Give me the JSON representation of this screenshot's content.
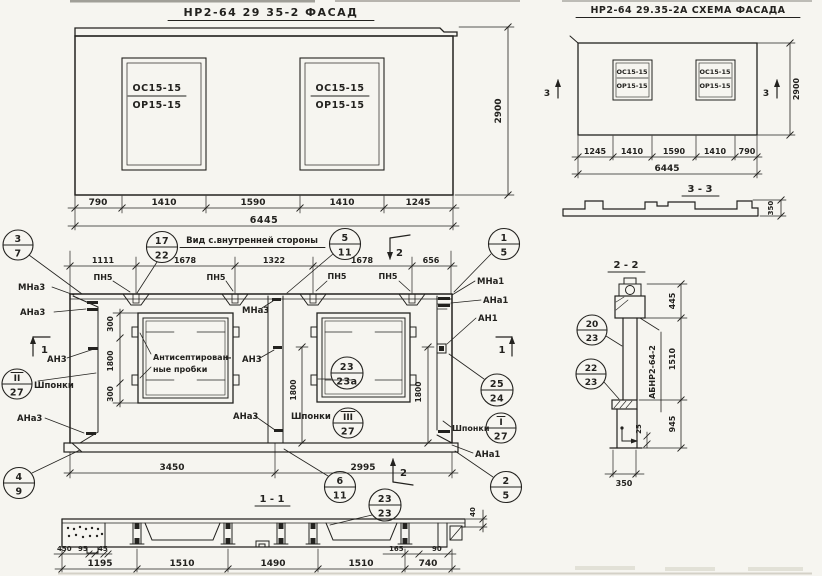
{
  "palette": {
    "ink": "#23221f",
    "paper": "#f6f5f0"
  },
  "facade": {
    "title": "НР2-64 29 35-2 ФАСАД",
    "win_top": "ОС15-15",
    "win_bot": "ОР15-15",
    "height": "2900",
    "dims": [
      "790",
      "1410",
      "1590",
      "1410",
      "1245"
    ],
    "total": "6445"
  },
  "schema": {
    "title": "НР2-64 29.35-2А СХЕМА ФАСАДА",
    "win_top": "ОС15-15",
    "win_bot": "ОР15-15",
    "height": "2900",
    "dims": [
      "1245",
      "1410",
      "1590",
      "1410",
      "790"
    ],
    "total": "6445",
    "cut": "3"
  },
  "sec33": {
    "title": "3 - 3",
    "dim350": "350"
  },
  "view": {
    "title": "Вид с.внутренней стороны",
    "top_dims": [
      "1111",
      "1678",
      "1322",
      "1678",
      "656"
    ],
    "pn5": "ПН5",
    "mna3": "МНа3",
    "ana3": "АНа3",
    "an3": "АН3",
    "mna1": "МНа1",
    "ana1": "АНа1",
    "an1": "АН1",
    "shponki": "Шпонки",
    "note1": "Антисептирован-",
    "note2": "ные пробки",
    "d300": "300",
    "d1800": "1800",
    "d3450": "3450",
    "d2995": "2995",
    "cut1": "1",
    "cut2": "2",
    "c37": [
      "3",
      "7"
    ],
    "c1722": [
      "17",
      "22"
    ],
    "c511": [
      "5",
      "11"
    ],
    "c15": [
      "1",
      "5"
    ],
    "c2323a": [
      "23",
      "23а"
    ],
    "c2524": [
      "25",
      "24"
    ],
    "cI27": [
      "I",
      "27"
    ],
    "cII27": [
      "II",
      "27"
    ],
    "cIII27": [
      "III",
      "27"
    ],
    "c49": [
      "4",
      "9"
    ],
    "c611": [
      "6",
      "11"
    ],
    "c2323": [
      "23",
      "23"
    ],
    "c25": [
      "2",
      "5"
    ]
  },
  "sec11": {
    "title": "1 - 1",
    "small_left": [
      "450",
      "95",
      "45"
    ],
    "dims": [
      "1195",
      "1510",
      "1490",
      "1510",
      "740"
    ],
    "small_right": [
      "165",
      "90"
    ],
    "d40": "40"
  },
  "sec22": {
    "title": "2 - 2",
    "d445": "445",
    "d1510": "1510",
    "d945": "945",
    "d25": "25",
    "d350": "350",
    "ref": "АБНР2-64-2",
    "c2023": [
      "20",
      "23"
    ],
    "c2223": [
      "22",
      "23"
    ]
  }
}
